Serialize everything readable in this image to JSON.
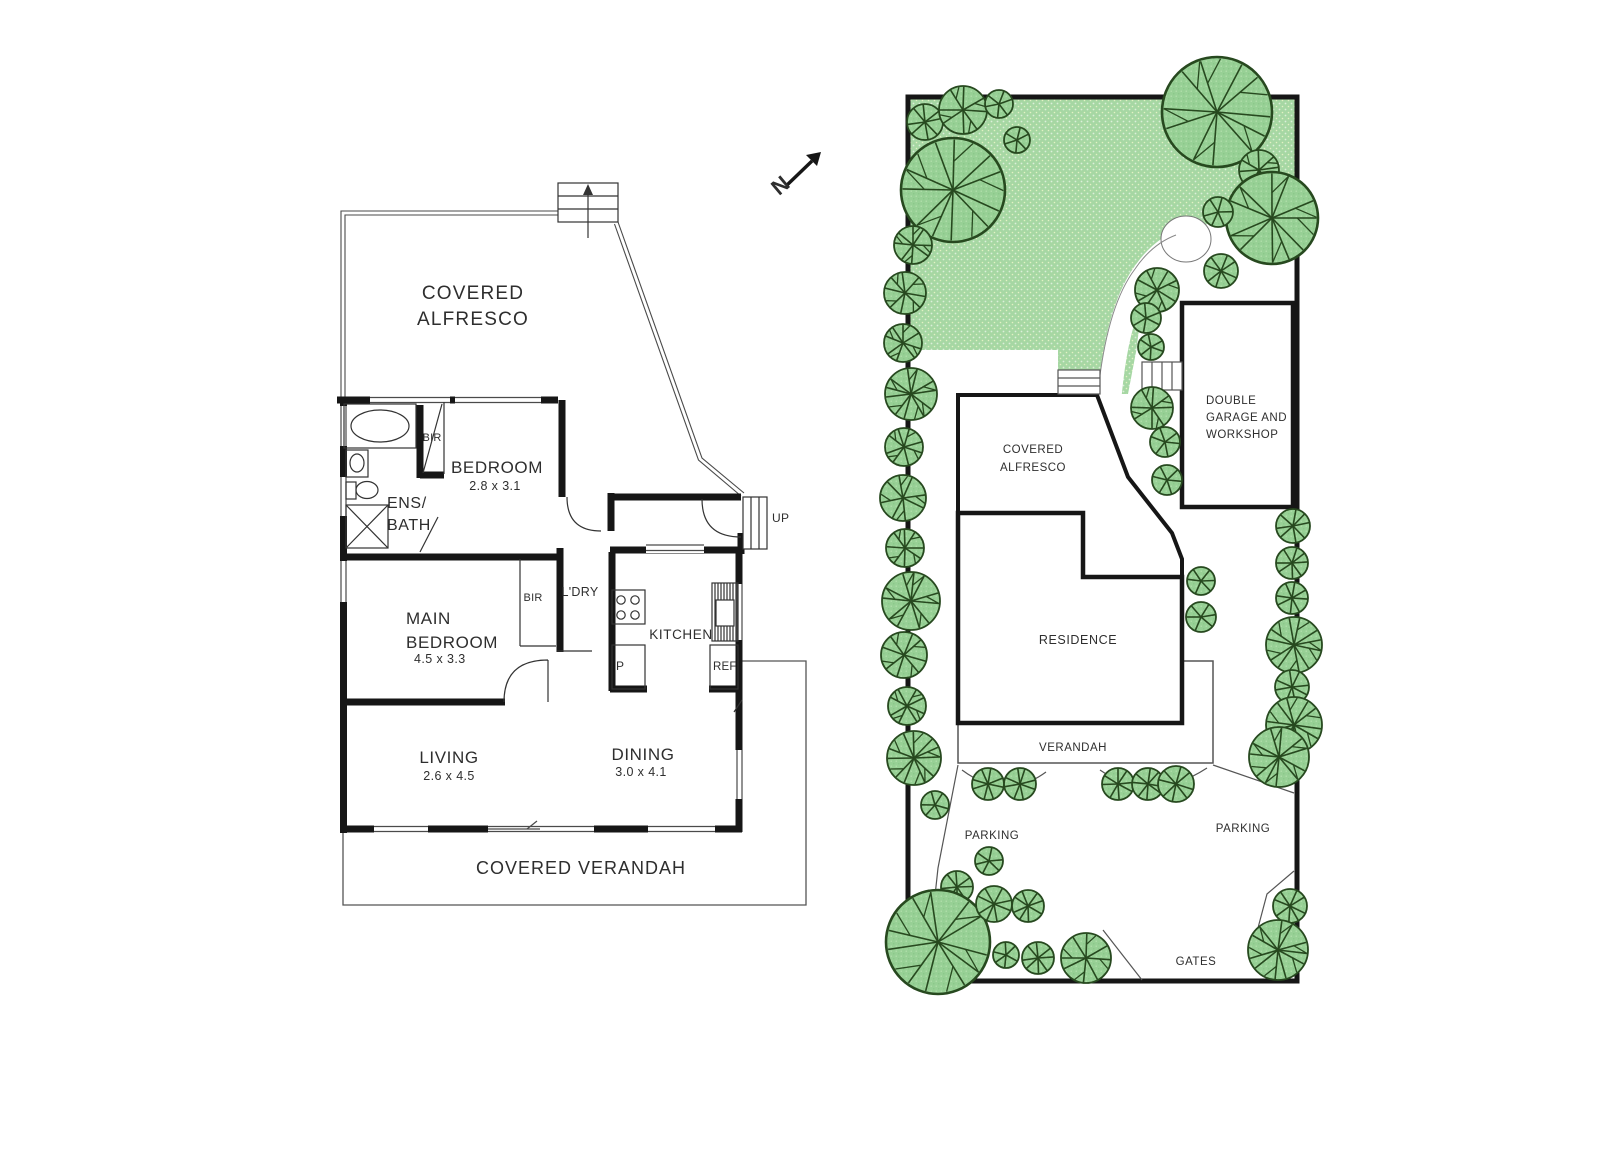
{
  "compass": {
    "north_label": "N"
  },
  "floor_plan": {
    "alfresco_line1": "COVERED",
    "alfresco_line2": "ALFRESCO",
    "ens_line1": "ENS/",
    "ens_line2": "BATH",
    "bir_bath": "BIR",
    "bedroom_name": "BEDROOM",
    "bedroom_dim": "2.8 x 3.1",
    "main_bedroom_line1": "MAIN",
    "main_bedroom_line2": "BEDROOM",
    "main_bedroom_dim": "4.5 x 3.3",
    "bir_main": "BIR",
    "laundry": "L'DRY",
    "kitchen": "KITCHEN",
    "pantry": "P",
    "fridge": "REF",
    "dining_name": "DINING",
    "dining_dim": "3.0 x 4.1",
    "living_name": "LIVING",
    "living_dim": "2.6 x 4.5",
    "verandah": "COVERED VERANDAH",
    "stairs_up_label": "UP"
  },
  "site_plan": {
    "alfresco_line1": "COVERED",
    "alfresco_line2": "ALFRESCO",
    "residence": "RESIDENCE",
    "verandah": "VERANDAH",
    "garage_line1": "DOUBLE",
    "garage_line2": "GARAGE AND",
    "garage_line3": "WORKSHOP",
    "parking_left": "PARKING",
    "parking_right": "PARKING",
    "gates": "GATES",
    "trees": [
      [
        925,
        122,
        18
      ],
      [
        963,
        110,
        24
      ],
      [
        999,
        104,
        14
      ],
      [
        1017,
        140,
        13
      ],
      [
        953,
        190,
        52
      ],
      [
        913,
        245,
        19
      ],
      [
        905,
        293,
        21
      ],
      [
        903,
        343,
        19
      ],
      [
        911,
        394,
        26
      ],
      [
        904,
        447,
        19
      ],
      [
        903,
        498,
        23
      ],
      [
        905,
        548,
        19
      ],
      [
        911,
        601,
        29
      ],
      [
        904,
        655,
        23
      ],
      [
        907,
        706,
        19
      ],
      [
        914,
        758,
        27
      ],
      [
        935,
        805,
        14
      ],
      [
        957,
        887,
        16
      ],
      [
        938,
        942,
        52
      ],
      [
        989,
        861,
        14
      ],
      [
        994,
        904,
        18
      ],
      [
        1028,
        906,
        16
      ],
      [
        1006,
        955,
        13
      ],
      [
        1038,
        958,
        16
      ],
      [
        1086,
        958,
        25
      ],
      [
        988,
        784,
        16
      ],
      [
        1020,
        784,
        16
      ],
      [
        1118,
        784,
        16
      ],
      [
        1148,
        784,
        16
      ],
      [
        1176,
        784,
        18
      ],
      [
        1290,
        906,
        17
      ],
      [
        1278,
        950,
        30
      ],
      [
        1217,
        112,
        55
      ],
      [
        1259,
        170,
        20
      ],
      [
        1272,
        218,
        46
      ],
      [
        1218,
        212,
        15
      ],
      [
        1221,
        271,
        17
      ],
      [
        1157,
        290,
        22
      ],
      [
        1146,
        318,
        15
      ],
      [
        1151,
        347,
        13
      ],
      [
        1152,
        408,
        21
      ],
      [
        1165,
        442,
        15
      ],
      [
        1167,
        480,
        15
      ],
      [
        1201,
        581,
        14
      ],
      [
        1201,
        617,
        15
      ],
      [
        1293,
        526,
        17
      ],
      [
        1292,
        563,
        16
      ],
      [
        1292,
        598,
        16
      ],
      [
        1294,
        645,
        28
      ],
      [
        1292,
        687,
        17
      ],
      [
        1294,
        725,
        28
      ],
      [
        1279,
        757,
        30
      ]
    ]
  },
  "colors": {
    "wall": "#161616",
    "thin_line": "#555555",
    "text": "#2e2e2e",
    "tree_fill": "#97d095",
    "tree_stroke": "#27491f",
    "lawn_fill": "#a6d7a3",
    "lawn_dot": "#eef7c9"
  }
}
